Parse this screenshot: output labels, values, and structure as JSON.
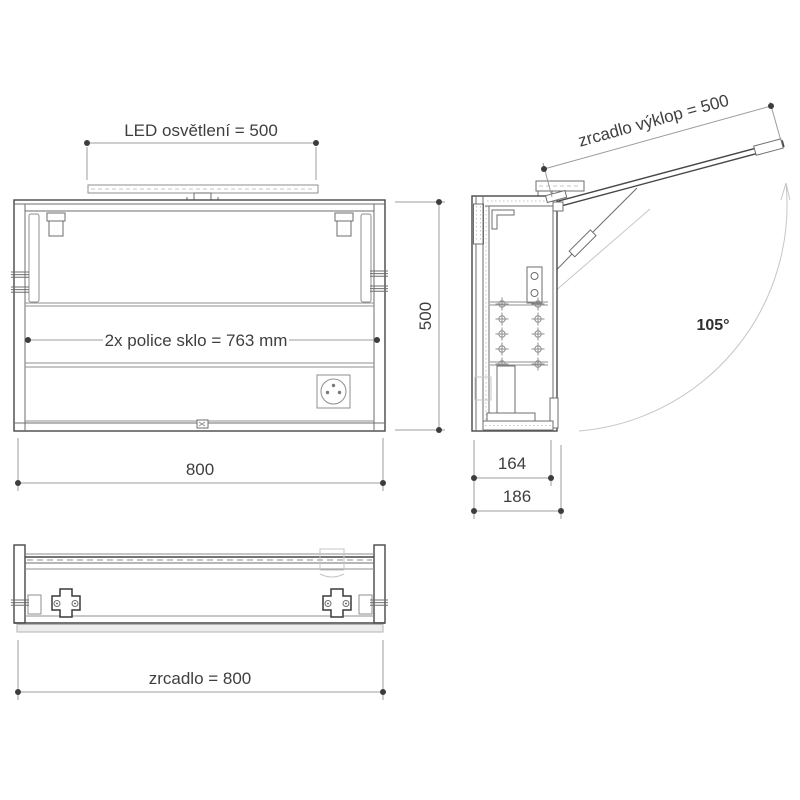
{
  "drawing": {
    "type": "technical-drawing",
    "subject": "mirror cabinet with LED lighting - 3 orthographic views",
    "colors": {
      "line": "#474747",
      "dimension_line": "#9c9c9c",
      "ghost_line": "#c6c6c6",
      "text": "#3f3f3f",
      "background": "#ffffff"
    },
    "front_view": {
      "dimensions": {
        "led_width": "LED osvětlení = 500",
        "shelf_width": "2x  police sklo = 763 mm",
        "cabinet_width": "800",
        "cabinet_height": "500"
      }
    },
    "side_view": {
      "dimensions": {
        "mirror_tilt": "zrcadlo výklop = 500",
        "opening_angle": "105°",
        "depth_body": "164",
        "depth_total": "186"
      }
    },
    "plan_view": {
      "dimensions": {
        "mirror_width": "zrcadlo = 800"
      }
    },
    "icons": {
      "power_socket": "circle-socket-with-pins",
      "shelf_pin": "crosshair-circle",
      "wall_bracket": "cross-plate-two-screws",
      "angle_arrow": "open-arrowhead"
    }
  }
}
